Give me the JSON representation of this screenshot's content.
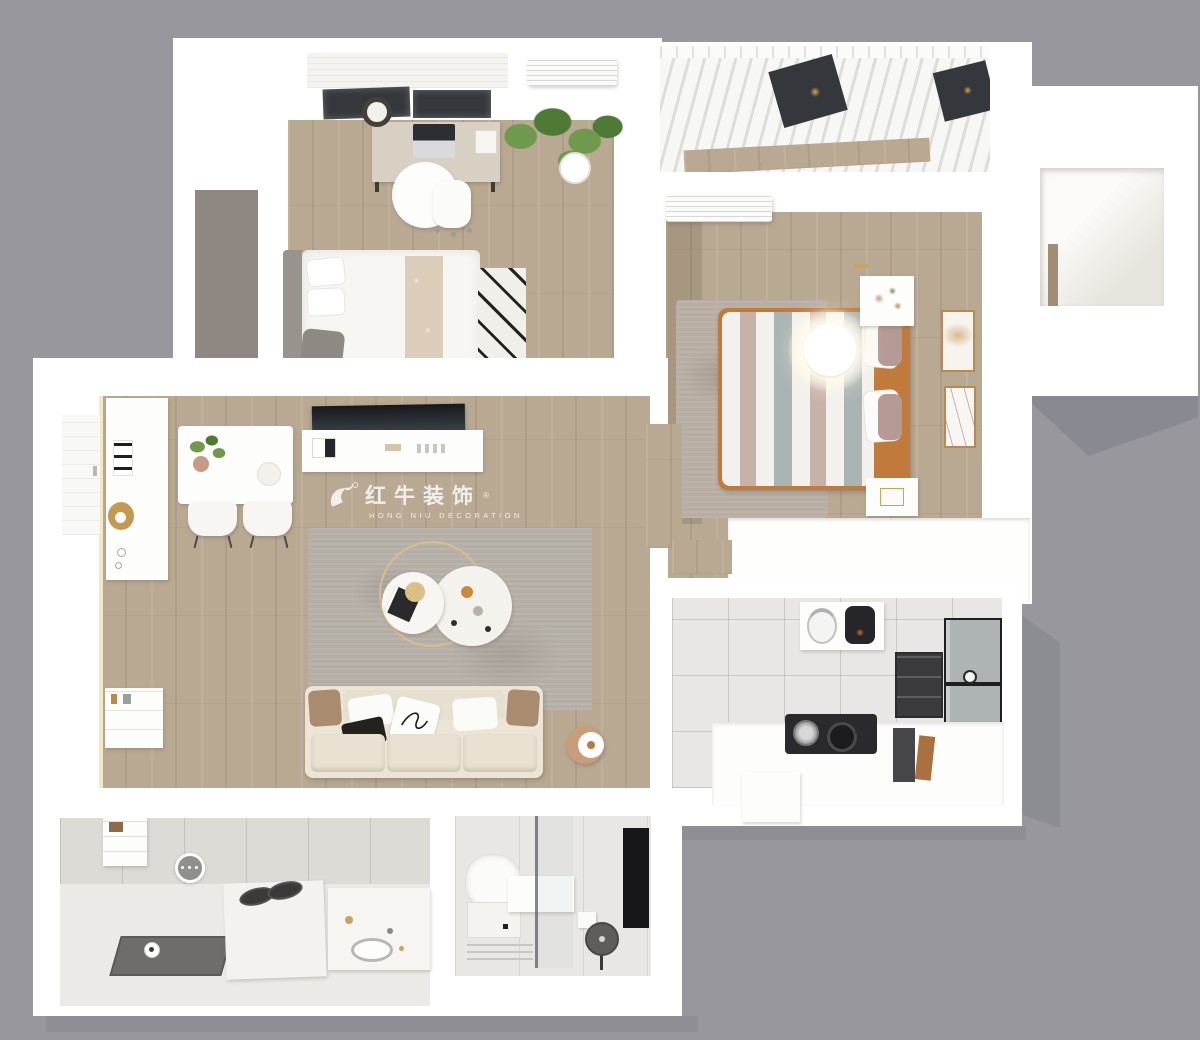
{
  "watermark": {
    "logo": "bull-logo",
    "brand_cn": "红牛装饰",
    "registered": "®",
    "brand_en": "HONG NIU DECORATION"
  },
  "palette": {
    "bg": "#97979d",
    "shadow": "#8b8b92",
    "wall": "#ffffff",
    "wall_shade": "#f0efe9",
    "wood": "#b9a892",
    "wood_dark": "#a18c76",
    "tile": "#e9e7e3",
    "tile_line": "#b7b5af",
    "rug_living": "#b4aea6",
    "rug_bedroom": "#b8ada2",
    "wardrobe": "#8f8781",
    "sofa_cream": "#ece4d4",
    "sofa_seat": "#e9e1d1",
    "arm_brown": "#a98c70",
    "bed_tan": "#c07a3c",
    "stripe_mauve": "#c7b2aa",
    "stripe_gray": "#aab4b2",
    "runner": "#dbcdb9",
    "plant": "#6f9a4e",
    "plant_dark": "#4f7a36",
    "gold": "#c9a25e",
    "appliance": "#2c2c30",
    "fridge": "#aeb3b3",
    "glass": "#34383c",
    "led": "#f4e7c6",
    "curtain": "#f7f7f5",
    "shower": "#6f6d69",
    "panel_black": "#17171a"
  }
}
